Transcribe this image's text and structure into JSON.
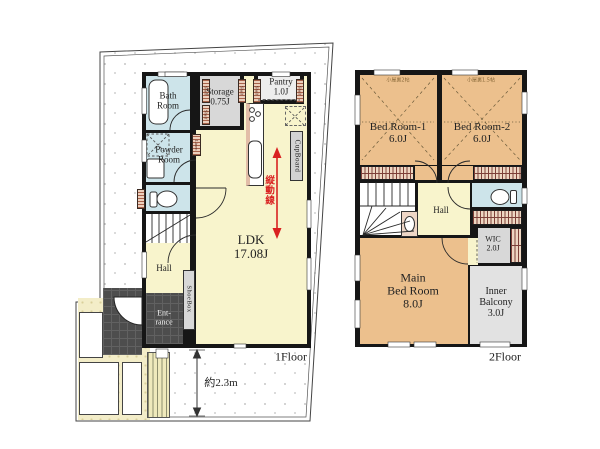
{
  "floor1": {
    "floor_label": "1Floor",
    "rooms": {
      "bath": "Bath\nRoom",
      "powder": "Powder\nRoom",
      "storage": "Storage\n0.75J",
      "pantry": "Pantry\n1.0J",
      "cupboard": "CupBoard",
      "ldk": "LDK\n17.08J",
      "hall": "Hall",
      "entrance": "Ent-\nrance",
      "shoebox": "ShoeBox"
    },
    "tags": {
      "shelf": "Shelf",
      "linen": "Linen"
    },
    "annotations": {
      "flow_line": "縦動線",
      "dimension": "約2.3m"
    }
  },
  "floor2": {
    "floor_label": "2Floor",
    "rooms": {
      "bed1": "Bed Room-1\n6.0J",
      "bed2": "Bed Room-2\n6.0J",
      "hall": "Hall",
      "wic": "WIC\n2.0J",
      "main_bed": "Main\nBed Room\n8.0J",
      "inner_balcony": "Inner\nBalcony\n3.0J"
    },
    "annotations": {
      "attic1": "小屋裏2帖",
      "attic2": "小屋裏1.5帖"
    }
  },
  "colors": {
    "wall": "#161616",
    "room_yellow": "#f8f4cc",
    "room_blue": "#cde4ea",
    "room_orange": "#ecc08d",
    "room_gray": "#d8d8d8",
    "accent_red": "#d92121"
  }
}
